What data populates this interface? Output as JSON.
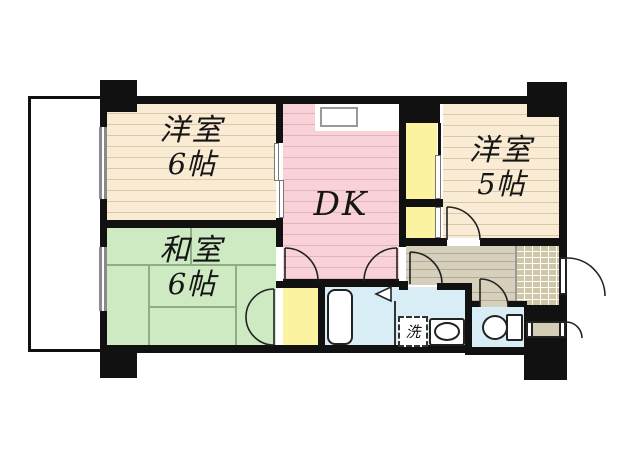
{
  "rooms": {
    "western6": {
      "name": "洋室",
      "size": "6帖"
    },
    "western5": {
      "name": "洋室",
      "size": "5帖"
    },
    "japanese6": {
      "name": "和室",
      "size": "6帖"
    },
    "dk": {
      "name": "DK"
    },
    "laundry": {
      "symbol": "洗"
    }
  },
  "colors": {
    "wall": "#111111",
    "western_room_floor": "#faecd4",
    "western_room_line": "#d9c9a9",
    "dk_floor": "#f8d2d8",
    "dk_line": "#e3b3bb",
    "japanese_room_floor": "#cdeac2",
    "tatami_line": "#8fae85",
    "closet": "#fbf3a0",
    "hallway_floor": "#d6cfbc",
    "genkan_tile": "#cfc6a8",
    "wet_area_floor": "#d8edf6",
    "balcony": "#ffffff"
  }
}
